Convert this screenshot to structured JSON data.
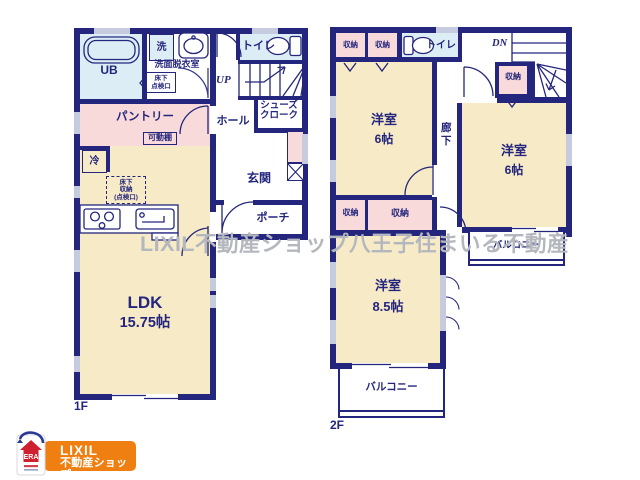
{
  "watermark": "LIXIL不動産ショップ八王子住まいる不動産",
  "floor1": {
    "label": "1F",
    "bath": "UB",
    "washer": "洗",
    "washroom": "洗面脱衣室",
    "hatch": [
      "床下",
      "点検口"
    ],
    "toilet": "トイレ",
    "stairs_dir": "UP",
    "hall": "ホール",
    "shoes": [
      "シューズ",
      "クローク"
    ],
    "pantry": "パントリー",
    "shelf": "可動棚",
    "fridge": "冷",
    "underfloor": [
      "床下",
      "収納",
      "(点検口)"
    ],
    "entrance": "玄関",
    "porch": "ポーチ",
    "ldk_name": "LDK",
    "ldk_size": "15.75帖"
  },
  "floor2": {
    "label": "2F",
    "closets": [
      "収納",
      "収納",
      "収納",
      "収納",
      "収納"
    ],
    "toilet": "トイレ",
    "stairs_dir": "DN",
    "corridor": "廊下",
    "rooms": [
      {
        "name": "洋室",
        "size": "6帖"
      },
      {
        "name": "洋室",
        "size": "6帖"
      },
      {
        "name": "洋室",
        "size": "8.5帖"
      }
    ],
    "balconies": [
      "バルコニー",
      "バルコニー"
    ]
  },
  "logo": {
    "emblem_text": "ERA",
    "brand": "LIXIL",
    "brand_sub": "不動産ショップ"
  },
  "colors": {
    "wall": "#24267d",
    "room_cream": "#f7eac7",
    "closet_pink": "#f9dada",
    "wet_blue": "#dcedf6",
    "window_gray": "#c7cbdf",
    "watermark_gray": "#b4b7be",
    "logo_orange": "#ef7f10",
    "logo_red": "#cf2030",
    "logo_swoosh_blue": "#2b3a92"
  }
}
